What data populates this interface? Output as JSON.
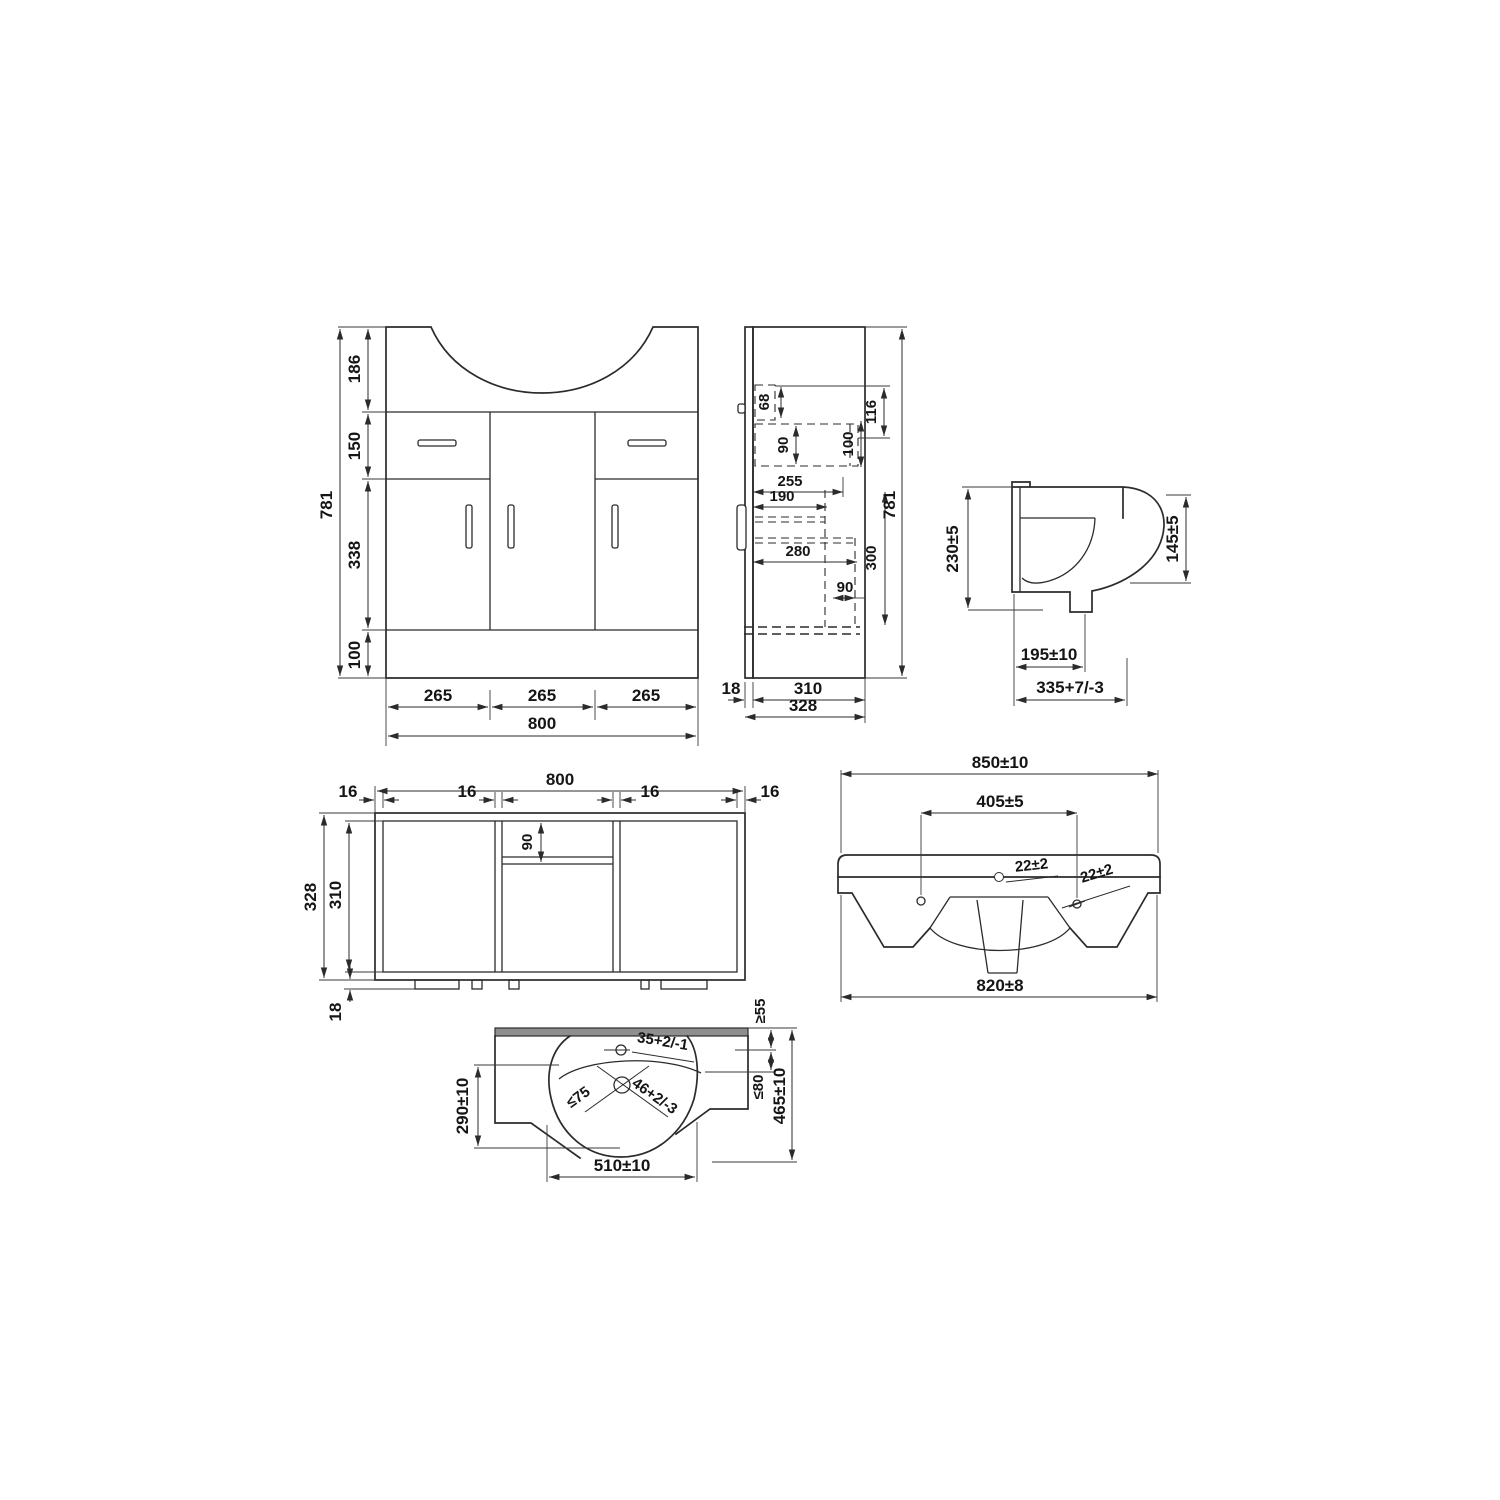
{
  "page": {
    "background": "#ffffff",
    "line_color": "#2b2b2b",
    "text_color": "#151515"
  },
  "views": {
    "front": {
      "heights": [
        "186",
        "150",
        "338",
        "100"
      ],
      "total_height": "781",
      "widths": [
        "265",
        "265",
        "265"
      ],
      "total_width": "800"
    },
    "side": {
      "dims": [
        "68",
        "90",
        "100",
        "116",
        "255",
        "190",
        "280",
        "90",
        "300"
      ],
      "total_height": "781",
      "bottom_dims": [
        "18",
        "310",
        "328"
      ]
    },
    "basin_profile": {
      "back_height": "230±5",
      "front_height": "145±5",
      "drain_offset": "195±10",
      "total_depth": "335+7/-3"
    },
    "plan": {
      "total_width": "800",
      "thicknesses": [
        "16",
        "16",
        "16",
        "16"
      ],
      "rail_depth": "90",
      "outer_depth": "328",
      "inner_depth": "310",
      "foot_height": "18"
    },
    "basin_front": {
      "top_width": "850±10",
      "tap_spacing": "405±5",
      "tap_dia_a": "22±2",
      "tap_dia_b": "22±2",
      "bottom_width": "820±8"
    },
    "basin_plan": {
      "tap_hole_dia": "35+2/-1",
      "front_edge_gap": "≥55",
      "side_edge_gap": "≤80",
      "total_depth": "465±10",
      "drain_clearance": "≤75",
      "drain_dia": "46+2/-3",
      "bowl_depth": "290±10",
      "bowl_width": "510±10"
    }
  }
}
